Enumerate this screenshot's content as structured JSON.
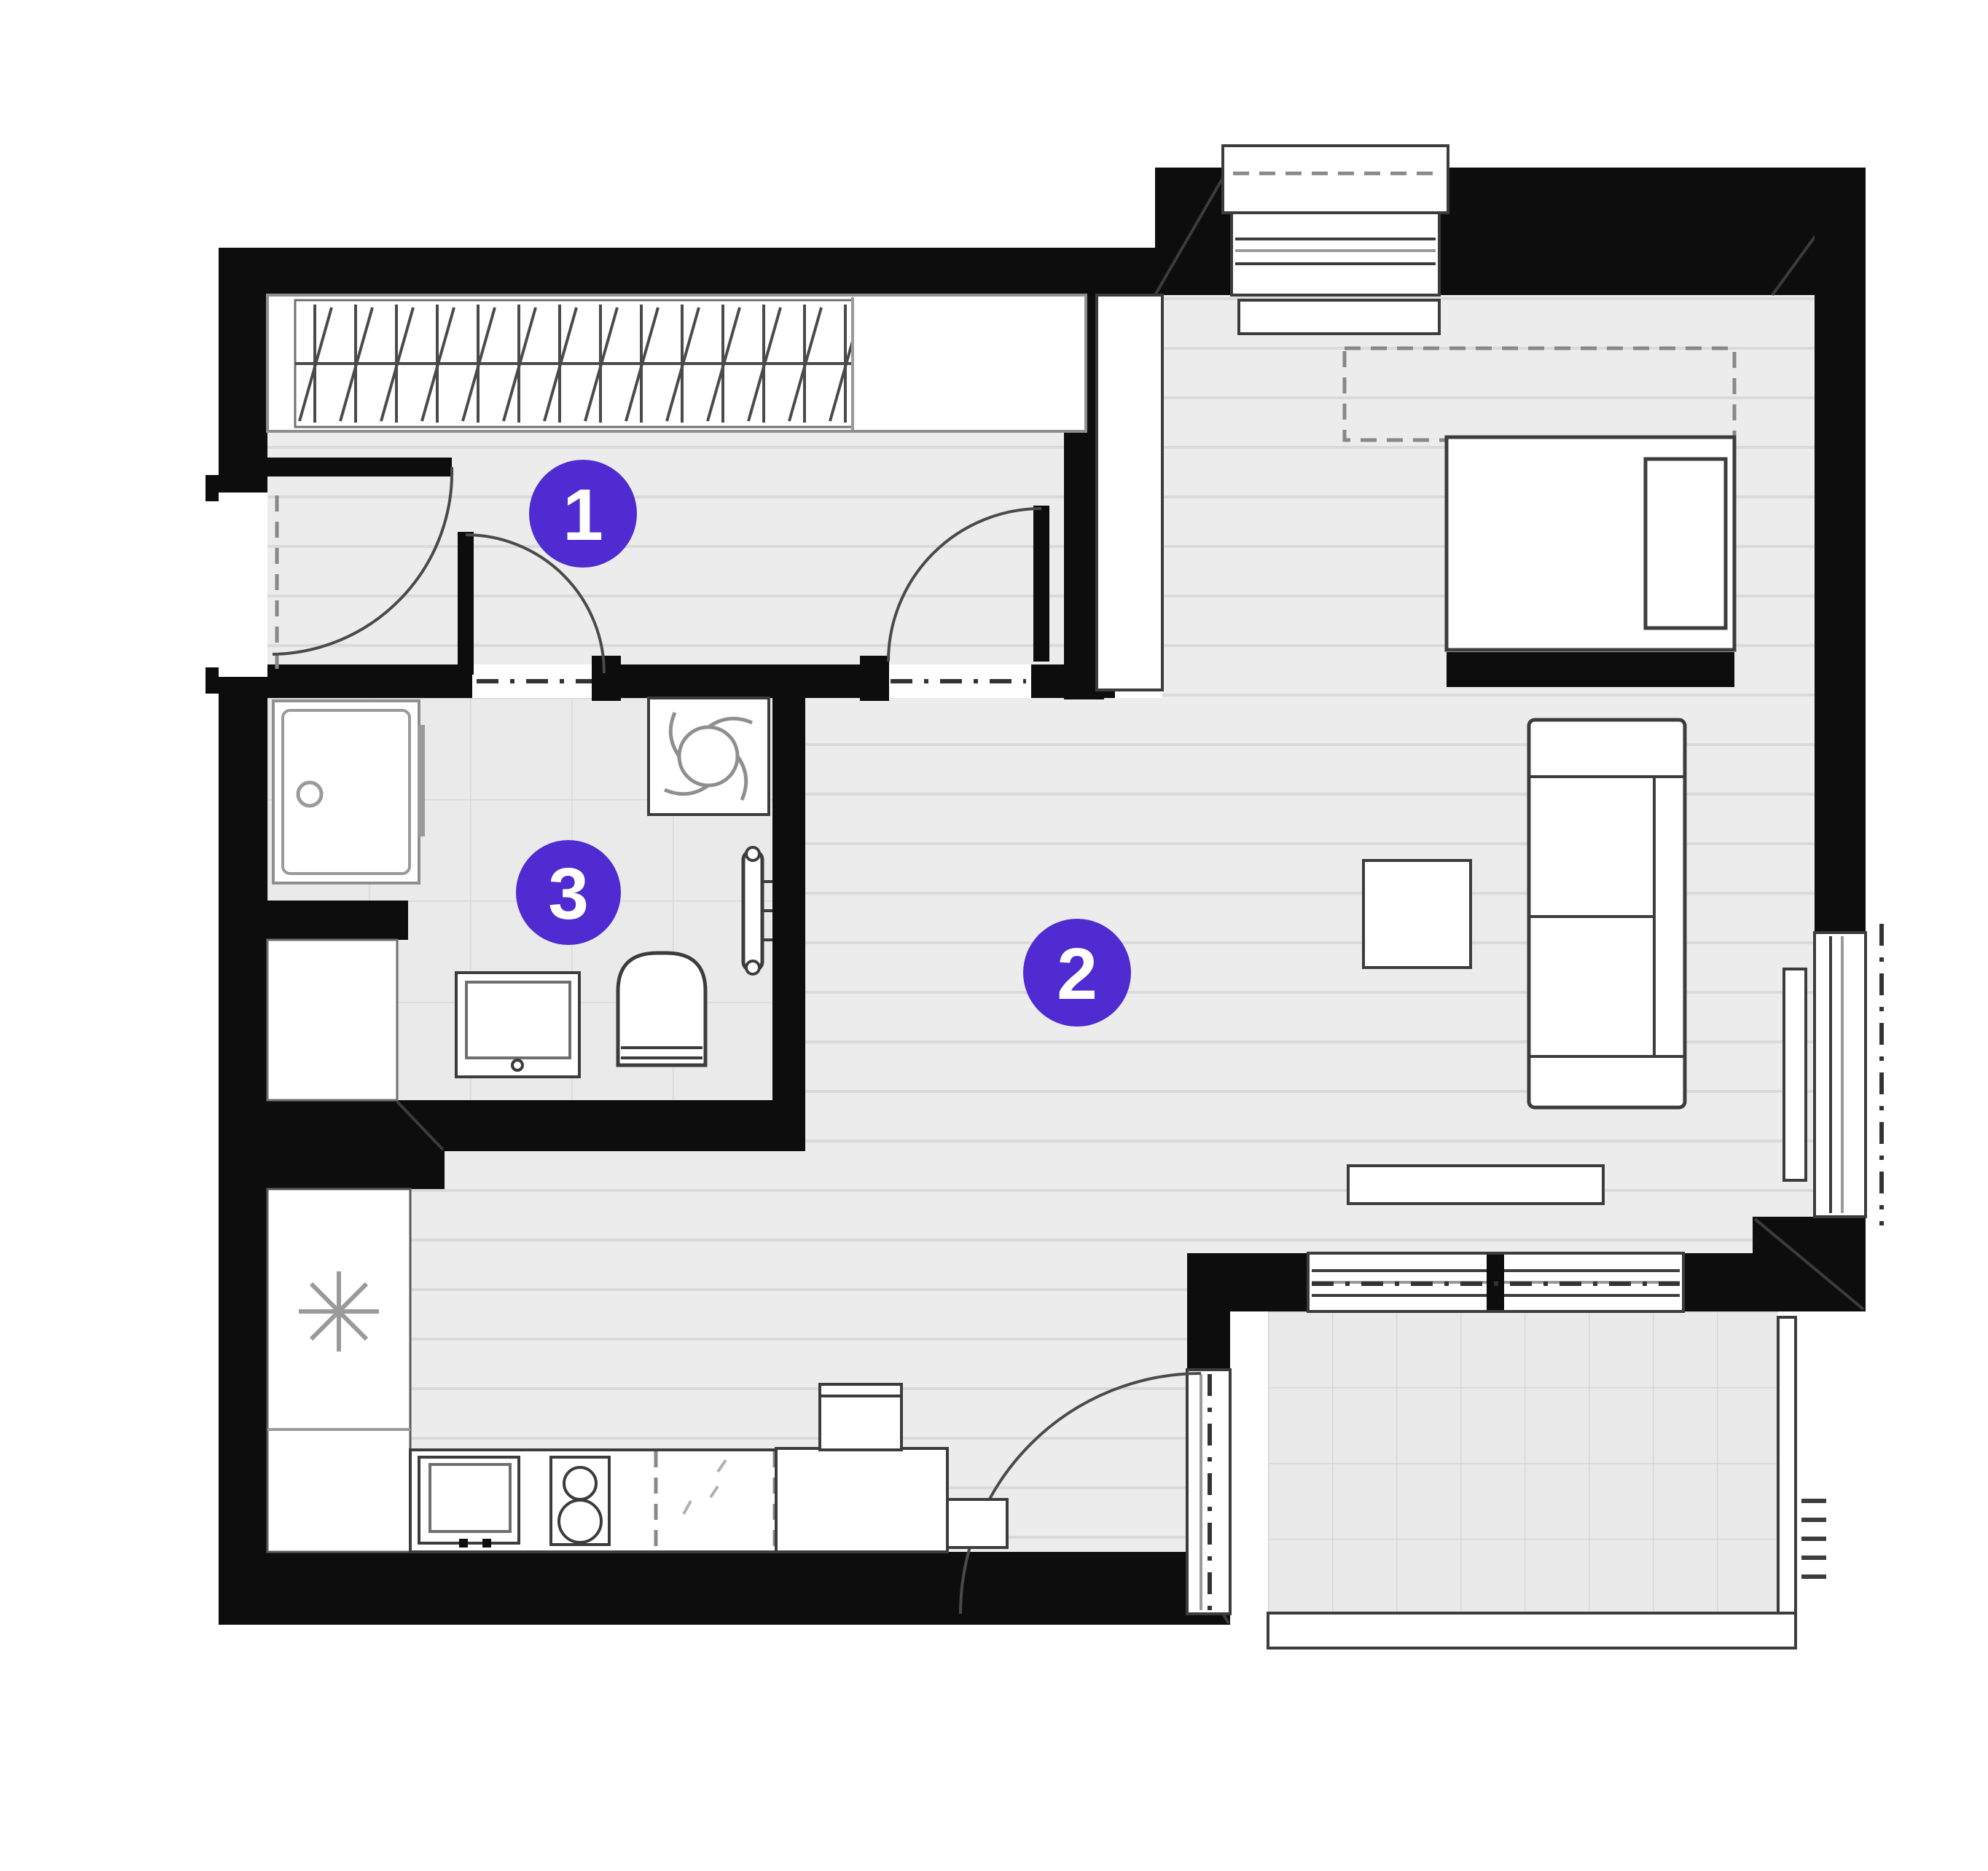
{
  "plan": {
    "type": "apartment-floor-plan",
    "markers": [
      {
        "label": "1"
      },
      {
        "label": "2"
      },
      {
        "label": "3"
      }
    ],
    "colors": {
      "marker_accent": "#4f2bd1",
      "wall": "#0d0d0d",
      "floor": "#ececec",
      "background": "#ffffff"
    },
    "icons": [
      "fridge-snowflake-icon",
      "washing-machine-impeller-icon",
      "shower-drain-icon",
      "hob-burners-icon",
      "wardrobe-hanger-hatch-icon"
    ]
  }
}
